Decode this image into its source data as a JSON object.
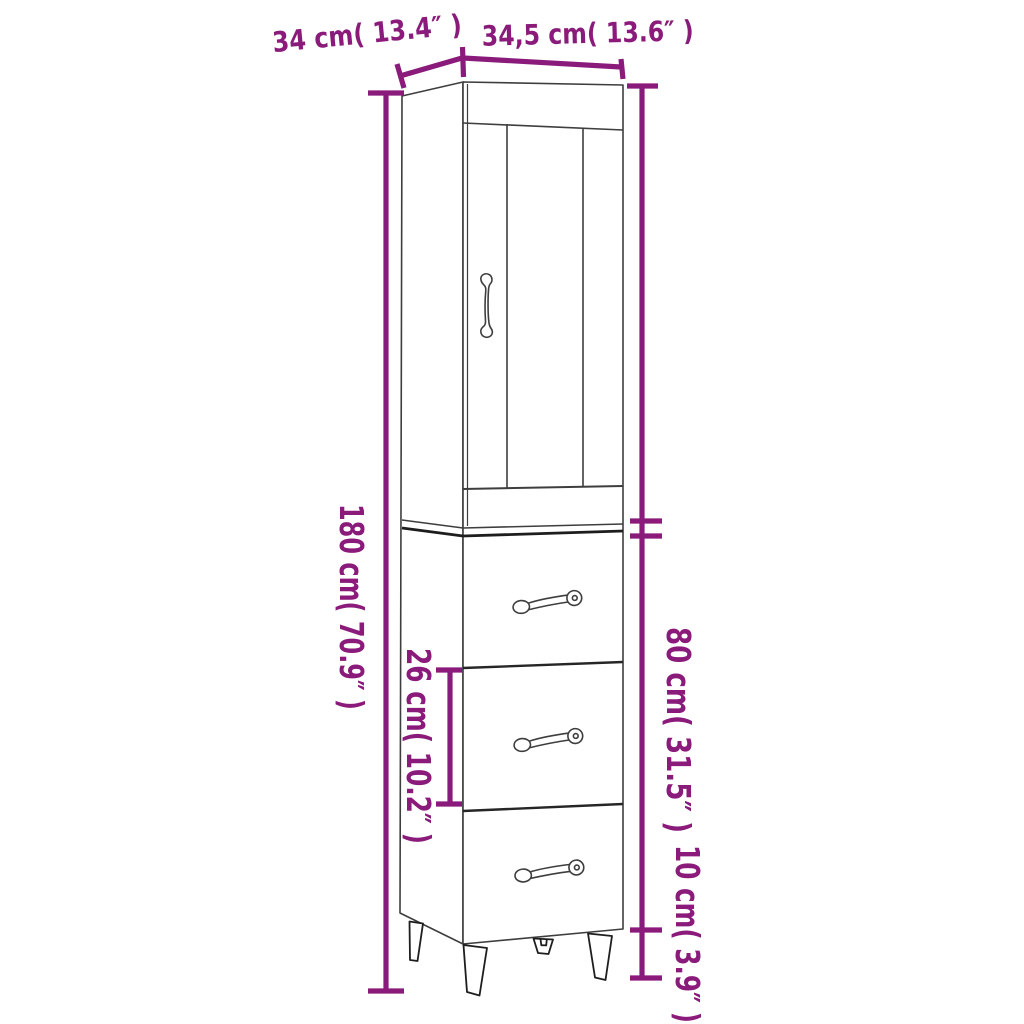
{
  "diagram": {
    "type": "furniture-dimension-diagram",
    "subject": "tall highboard cabinet with glass door, three drawers and splayed legs",
    "accent_color": "#8a1b7b",
    "outline_color": "#3e3e3e",
    "background": "#ffffff"
  },
  "dimensions": {
    "top_depth": {
      "label": "34 cm( 13.4″ )",
      "cm": "34",
      "inch": "13.4"
    },
    "top_width": {
      "label": "34,5 cm( 13.6″ )",
      "cm": "34,5",
      "inch": "13.6"
    },
    "total_height": {
      "label": "180 cm( 70.9″ )",
      "cm": "180",
      "inch": "70.9"
    },
    "drawer_spacing": {
      "label": "26 cm( 10.2″ )",
      "cm": "26",
      "inch": "10.2"
    },
    "lower_section_height": {
      "label": "80 cm( 31.5″ )",
      "cm": "80",
      "inch": "31.5"
    },
    "leg_height": {
      "label": "10 cm( 3.9″ )",
      "cm": "10",
      "inch": "3.9"
    }
  }
}
